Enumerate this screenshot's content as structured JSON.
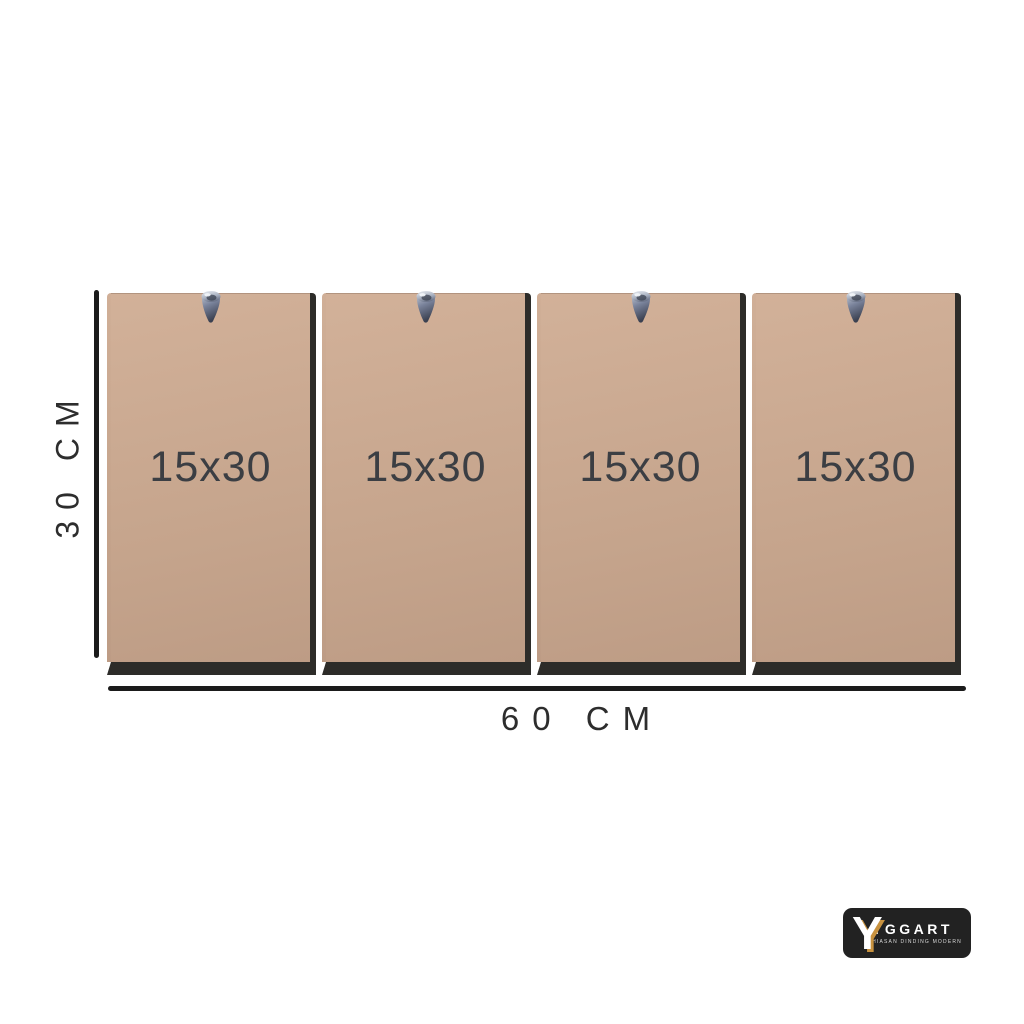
{
  "page": {
    "background": "#ffffff"
  },
  "diagram": {
    "panel_count": 4,
    "panels": [
      {
        "label": "15x30"
      },
      {
        "label": "15x30"
      },
      {
        "label": "15x30"
      },
      {
        "label": "15x30"
      }
    ],
    "height_dimension": "30 CM",
    "width_dimension": "60 CM",
    "hook_icon": "metal-wall-hook",
    "colors": {
      "panel": "#c9a890",
      "panel_edge": "#2d2c29",
      "dimension_line": "#1b1b1b",
      "label_text": "#3b3e43"
    }
  },
  "logo": {
    "monogram": "Y",
    "brand": "YGGART",
    "tagline": "HIASAN DINDING MODERN",
    "colors": {
      "background": "#222222",
      "accent": "#c8923f",
      "text": "#ffffff"
    }
  }
}
